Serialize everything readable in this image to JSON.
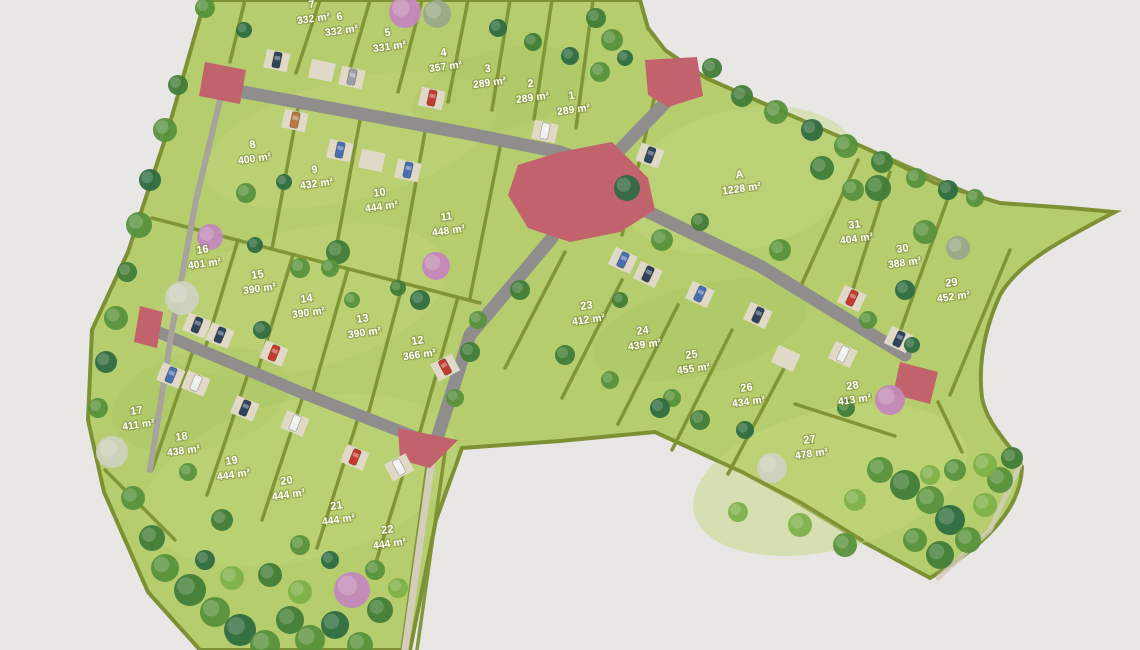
{
  "palette": {
    "background": "#e8e7e5",
    "grass": "#b5cd6d",
    "grass_light": "#c3d77e",
    "grass_dark": "#a9c25f",
    "hedge": "#7d9134",
    "road": "#908e8c",
    "path": "#d5cdbc",
    "plaza": "#c2626d",
    "pad": "#e0d9c7",
    "label": "#ffffff",
    "tree_shades": [
      "#6fa23e",
      "#59913d",
      "#417c38",
      "#2f6b41",
      "#7fb14a",
      "#8fbf55"
    ],
    "tree_pink": "#c487bc",
    "tree_white": "#ccd2bf",
    "tree_graygreen": "#9aa98a",
    "car_colors": {
      "dark": "#30435c",
      "gray": "#9aa0a6",
      "red": "#c23b2e",
      "white": "#eef0ee",
      "blue": "#4a6fae",
      "orange": "#b97a41"
    }
  },
  "plan": {
    "label_rotation_deg": -8,
    "plots": [
      {
        "id": "7",
        "area": "332 m²",
        "x": 312,
        "y": 8
      },
      {
        "id": "6",
        "area": "332 m²",
        "x": 340,
        "y": 20
      },
      {
        "id": "5",
        "area": "331 m²",
        "x": 388,
        "y": 36
      },
      {
        "id": "4",
        "area": "357 m²",
        "x": 444,
        "y": 56
      },
      {
        "id": "3",
        "area": "289 m²",
        "x": 488,
        "y": 72
      },
      {
        "id": "2",
        "area": "289 m²",
        "x": 531,
        "y": 87
      },
      {
        "id": "1",
        "area": "289 m²",
        "x": 572,
        "y": 99
      },
      {
        "id": "8",
        "area": "400 m²",
        "x": 253,
        "y": 148
      },
      {
        "id": "9",
        "area": "432 m²",
        "x": 315,
        "y": 173
      },
      {
        "id": "10",
        "area": "444 m²",
        "x": 380,
        "y": 196
      },
      {
        "id": "11",
        "area": "448 m²",
        "x": 447,
        "y": 220
      },
      {
        "id": "16",
        "area": "401 m²",
        "x": 203,
        "y": 253
      },
      {
        "id": "15",
        "area": "390 m²",
        "x": 258,
        "y": 278
      },
      {
        "id": "14",
        "area": "390 m²",
        "x": 307,
        "y": 302
      },
      {
        "id": "13",
        "area": "390 m²",
        "x": 363,
        "y": 322
      },
      {
        "id": "12",
        "area": "366 m²",
        "x": 418,
        "y": 344
      },
      {
        "id": "17",
        "area": "411 m²",
        "x": 137,
        "y": 414
      },
      {
        "id": "18",
        "area": "438 m²",
        "x": 182,
        "y": 440
      },
      {
        "id": "19",
        "area": "444 m²",
        "x": 232,
        "y": 464
      },
      {
        "id": "20",
        "area": "444 m²",
        "x": 287,
        "y": 484
      },
      {
        "id": "21",
        "area": "444 m²",
        "x": 337,
        "y": 509
      },
      {
        "id": "22",
        "area": "444 m²",
        "x": 388,
        "y": 533
      },
      {
        "id": "A",
        "area": "1228 m²",
        "x": 740,
        "y": 178
      },
      {
        "id": "31",
        "area": "404 m²",
        "x": 855,
        "y": 228
      },
      {
        "id": "30",
        "area": "388 m²",
        "x": 903,
        "y": 252
      },
      {
        "id": "29",
        "area": "452 m²",
        "x": 952,
        "y": 286
      },
      {
        "id": "23",
        "area": "412 m²",
        "x": 587,
        "y": 309
      },
      {
        "id": "24",
        "area": "439 m²",
        "x": 643,
        "y": 334
      },
      {
        "id": "25",
        "area": "455 m²",
        "x": 692,
        "y": 358
      },
      {
        "id": "26",
        "area": "434 m²",
        "x": 747,
        "y": 391
      },
      {
        "id": "28",
        "area": "413 m²",
        "x": 853,
        "y": 389
      },
      {
        "id": "27",
        "area": "478 m²",
        "x": 810,
        "y": 443
      }
    ]
  }
}
